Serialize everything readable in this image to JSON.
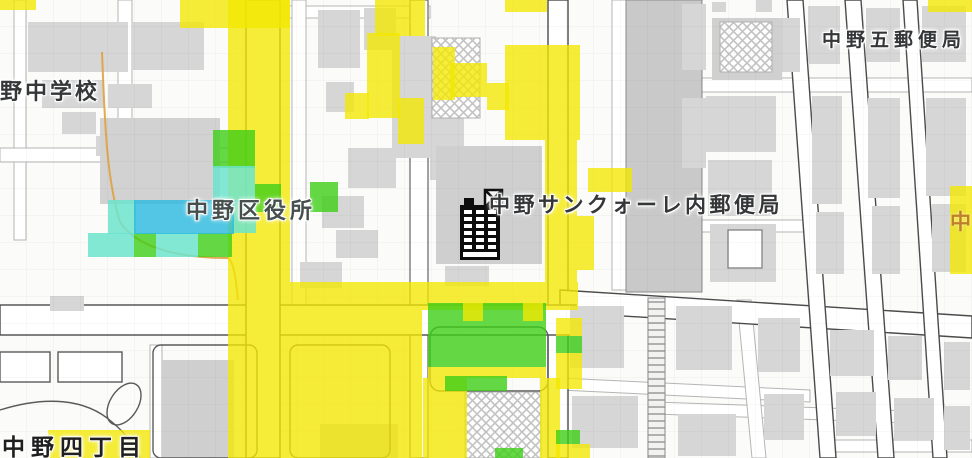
{
  "map": {
    "labels": [
      {
        "id": "school",
        "text": "野中学校"
      },
      {
        "id": "city-office",
        "text": "中野区役所"
      },
      {
        "id": "post-office-main",
        "text": "中野サンクォーレ内郵便局"
      },
      {
        "id": "post-office-five",
        "text": "中野五郵便局"
      },
      {
        "id": "district",
        "text": "中野四丁目"
      },
      {
        "id": "district-partial",
        "text": "中"
      }
    ],
    "poi": {
      "icon": "office-building-icon"
    },
    "overlay": {
      "colors": {
        "yellow": "rgba(244,232,0,0.78)",
        "green": "rgba(62,206,24,0.80)",
        "cyan": "rgba(108,228,206,0.85)",
        "blue": "rgba(40,185,222,0.80)"
      },
      "tiles": [
        {
          "x": 0,
          "y": 0,
          "w": 36,
          "h": 10,
          "c": "yellow"
        },
        {
          "x": 180,
          "y": 0,
          "w": 110,
          "h": 28,
          "c": "yellow"
        },
        {
          "x": 228,
          "y": 0,
          "w": 62,
          "h": 282,
          "c": "yellow"
        },
        {
          "x": 228,
          "y": 282,
          "w": 350,
          "h": 28,
          "c": "yellow"
        },
        {
          "x": 228,
          "y": 310,
          "w": 194,
          "h": 148,
          "c": "yellow"
        },
        {
          "x": 375,
          "y": 0,
          "w": 50,
          "h": 36,
          "c": "yellow"
        },
        {
          "x": 367,
          "y": 33,
          "w": 33,
          "h": 85,
          "c": "yellow"
        },
        {
          "x": 398,
          "y": 98,
          "w": 26,
          "h": 46,
          "c": "yellow"
        },
        {
          "x": 345,
          "y": 93,
          "w": 24,
          "h": 26,
          "c": "yellow"
        },
        {
          "x": 433,
          "y": 47,
          "w": 22,
          "h": 53,
          "c": "yellow"
        },
        {
          "x": 450,
          "y": 63,
          "w": 37,
          "h": 34,
          "c": "yellow"
        },
        {
          "x": 487,
          "y": 83,
          "w": 22,
          "h": 27,
          "c": "yellow"
        },
        {
          "x": 505,
          "y": 0,
          "w": 42,
          "h": 12,
          "c": "yellow"
        },
        {
          "x": 505,
          "y": 45,
          "w": 75,
          "h": 95,
          "c": "yellow"
        },
        {
          "x": 545,
          "y": 140,
          "w": 32,
          "h": 142,
          "c": "yellow"
        },
        {
          "x": 588,
          "y": 168,
          "w": 44,
          "h": 24,
          "c": "yellow"
        },
        {
          "x": 577,
          "y": 216,
          "w": 17,
          "h": 54,
          "c": "yellow"
        },
        {
          "x": 928,
          "y": 0,
          "w": 44,
          "h": 12,
          "c": "yellow"
        },
        {
          "x": 950,
          "y": 186,
          "w": 22,
          "h": 88,
          "c": "yellow"
        },
        {
          "x": 423,
          "y": 378,
          "w": 44,
          "h": 80,
          "c": "yellow"
        },
        {
          "x": 540,
          "y": 378,
          "w": 20,
          "h": 80,
          "c": "yellow"
        },
        {
          "x": 428,
          "y": 367,
          "w": 118,
          "h": 11,
          "c": "yellow"
        },
        {
          "x": 556,
          "y": 318,
          "w": 26,
          "h": 18,
          "c": "yellow"
        },
        {
          "x": 556,
          "y": 353,
          "w": 26,
          "h": 36,
          "c": "yellow"
        },
        {
          "x": 556,
          "y": 444,
          "w": 34,
          "h": 14,
          "c": "yellow"
        },
        {
          "x": 48,
          "y": 430,
          "w": 102,
          "h": 28,
          "c": "yellow"
        },
        {
          "x": 428,
          "y": 303,
          "w": 118,
          "h": 64,
          "c": "green"
        },
        {
          "x": 463,
          "y": 303,
          "w": 20,
          "h": 18,
          "c": "yellow"
        },
        {
          "x": 523,
          "y": 303,
          "w": 20,
          "h": 18,
          "c": "yellow"
        },
        {
          "x": 213,
          "y": 130,
          "w": 42,
          "h": 38,
          "c": "green"
        },
        {
          "x": 255,
          "y": 184,
          "w": 26,
          "h": 28,
          "c": "green"
        },
        {
          "x": 310,
          "y": 182,
          "w": 28,
          "h": 30,
          "c": "green"
        },
        {
          "x": 134,
          "y": 233,
          "w": 22,
          "h": 24,
          "c": "green"
        },
        {
          "x": 198,
          "y": 233,
          "w": 34,
          "h": 24,
          "c": "green"
        },
        {
          "x": 445,
          "y": 376,
          "w": 62,
          "h": 15,
          "c": "green"
        },
        {
          "x": 495,
          "y": 448,
          "w": 28,
          "h": 10,
          "c": "green"
        },
        {
          "x": 556,
          "y": 336,
          "w": 26,
          "h": 17,
          "c": "green"
        },
        {
          "x": 556,
          "y": 430,
          "w": 24,
          "h": 14,
          "c": "green"
        },
        {
          "x": 213,
          "y": 166,
          "w": 42,
          "h": 36,
          "c": "cyan"
        },
        {
          "x": 108,
          "y": 200,
          "w": 28,
          "h": 34,
          "c": "cyan"
        },
        {
          "x": 232,
          "y": 200,
          "w": 24,
          "h": 33,
          "c": "cyan"
        },
        {
          "x": 88,
          "y": 233,
          "w": 22,
          "h": 24,
          "c": "cyan"
        },
        {
          "x": 110,
          "y": 233,
          "w": 24,
          "h": 24,
          "c": "cyan"
        },
        {
          "x": 156,
          "y": 233,
          "w": 42,
          "h": 24,
          "c": "cyan"
        },
        {
          "x": 134,
          "y": 200,
          "w": 100,
          "h": 34,
          "c": "blue"
        }
      ]
    }
  }
}
